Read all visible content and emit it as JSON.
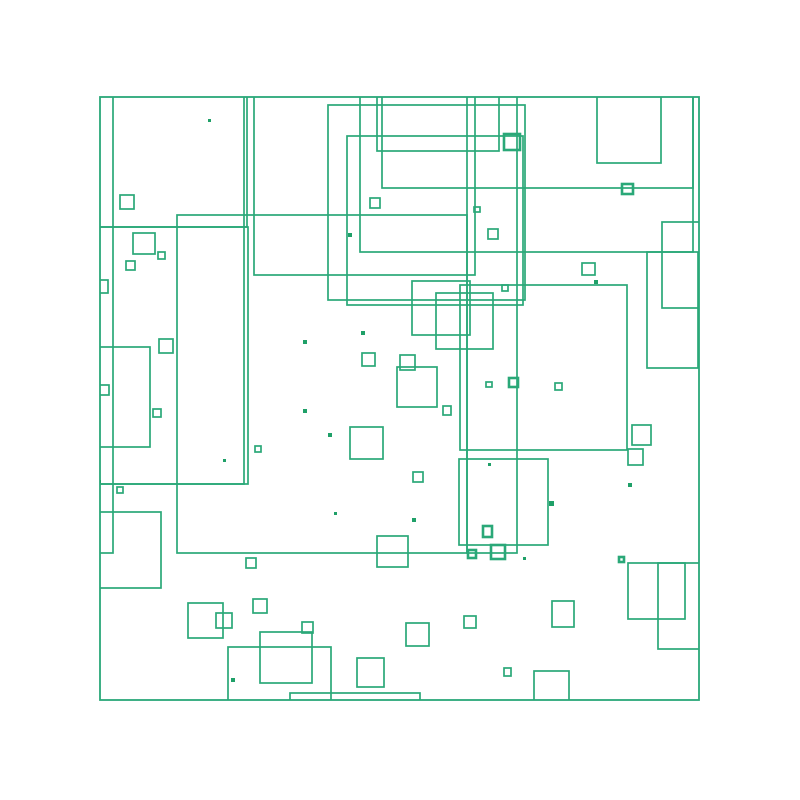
{
  "canvas": {
    "width": 800,
    "height": 800,
    "background": "#ffffff"
  },
  "artwork": {
    "description": "abstract composition of green outlined rectangles on white",
    "frame": {
      "x": 100,
      "y": 97,
      "w": 599,
      "h": 603
    },
    "stroke_color": "#2aa878",
    "dot_color": "#1fa068",
    "stroke_width": 1.7,
    "thick_stroke_width": 2.6,
    "frame_stroke_width": 1.8,
    "rects": [
      [
        328,
        105,
        197,
        195
      ],
      [
        347,
        136,
        176,
        169
      ],
      [
        377,
        93,
        122,
        58
      ],
      [
        254,
        93,
        221,
        182
      ],
      [
        360,
        93,
        333,
        159
      ],
      [
        382,
        93,
        311,
        95
      ],
      [
        597,
        93,
        64,
        70
      ],
      [
        662,
        222,
        40,
        86
      ],
      [
        647,
        252,
        51,
        116
      ],
      [
        412,
        281,
        58,
        54
      ],
      [
        436,
        293,
        57,
        56
      ],
      [
        460,
        285,
        167,
        165
      ],
      [
        467,
        93,
        50,
        460
      ],
      [
        177,
        215,
        290,
        338
      ],
      [
        84,
        88,
        160,
        396
      ],
      [
        88,
        92,
        159,
        135
      ],
      [
        92,
        227,
        156,
        257
      ],
      [
        80,
        84,
        33,
        469
      ],
      [
        95,
        347,
        55,
        100
      ],
      [
        459,
        459,
        89,
        86
      ],
      [
        94,
        512,
        67,
        76
      ],
      [
        228,
        647,
        103,
        55
      ],
      [
        290,
        693,
        130,
        8
      ],
      [
        628,
        563,
        57,
        56
      ],
      [
        658,
        563,
        44,
        86
      ],
      [
        188,
        603,
        35,
        35
      ],
      [
        216,
        613,
        16,
        15
      ],
      [
        260,
        632,
        52,
        51
      ],
      [
        350,
        427,
        33,
        32
      ],
      [
        397,
        367,
        40,
        40
      ],
      [
        377,
        536,
        31,
        31
      ],
      [
        357,
        658,
        27,
        29
      ],
      [
        534,
        671,
        35,
        31
      ],
      [
        632,
        425,
        19,
        20
      ],
      [
        628,
        449,
        15,
        16
      ],
      [
        552,
        601,
        22,
        26
      ],
      [
        406,
        623,
        23,
        23
      ],
      [
        120,
        195,
        14,
        14
      ],
      [
        133,
        233,
        22,
        21
      ],
      [
        158,
        252,
        7,
        7
      ],
      [
        126,
        261,
        9,
        9
      ],
      [
        96,
        280,
        12,
        13
      ],
      [
        159,
        339,
        14,
        14
      ],
      [
        95,
        385,
        14,
        10
      ],
      [
        153,
        409,
        8,
        8
      ],
      [
        246,
        558,
        10,
        10
      ],
      [
        253,
        599,
        14,
        14
      ],
      [
        302,
        622,
        11,
        11
      ],
      [
        362,
        353,
        13,
        13
      ],
      [
        400,
        355,
        15,
        15
      ],
      [
        443,
        406,
        8,
        9
      ],
      [
        413,
        472,
        10,
        10
      ],
      [
        488,
        229,
        10,
        10
      ],
      [
        582,
        263,
        13,
        12
      ],
      [
        486,
        382,
        6,
        5
      ],
      [
        555,
        383,
        7,
        7
      ],
      [
        502,
        285,
        6,
        6
      ],
      [
        474,
        207,
        6,
        5
      ],
      [
        464,
        616,
        12,
        12
      ],
      [
        504,
        668,
        7,
        8
      ],
      [
        255,
        446,
        6,
        6
      ],
      [
        117,
        487,
        6,
        6
      ],
      [
        370,
        198,
        10,
        10
      ]
    ],
    "thick_squares": [
      [
        504,
        134,
        16,
        16
      ],
      [
        622,
        184,
        11,
        10
      ],
      [
        483,
        526,
        9,
        11
      ],
      [
        491,
        545,
        14,
        14
      ],
      [
        468,
        550,
        8,
        8
      ],
      [
        619,
        557,
        5,
        5
      ],
      [
        509,
        378,
        9,
        9
      ]
    ],
    "dots": [
      [
        208,
        119,
        3
      ],
      [
        303,
        340,
        4
      ],
      [
        303,
        409,
        4
      ],
      [
        328,
        433,
        4
      ],
      [
        223,
        459,
        3
      ],
      [
        98,
        480,
        3
      ],
      [
        361,
        331,
        4
      ],
      [
        334,
        512,
        3
      ],
      [
        412,
        518,
        4
      ],
      [
        488,
        463,
        3
      ],
      [
        549,
        501,
        5
      ],
      [
        523,
        557,
        3
      ],
      [
        594,
        280,
        4
      ],
      [
        628,
        483,
        4
      ],
      [
        231,
        678,
        4
      ],
      [
        348,
        233,
        4
      ]
    ]
  }
}
